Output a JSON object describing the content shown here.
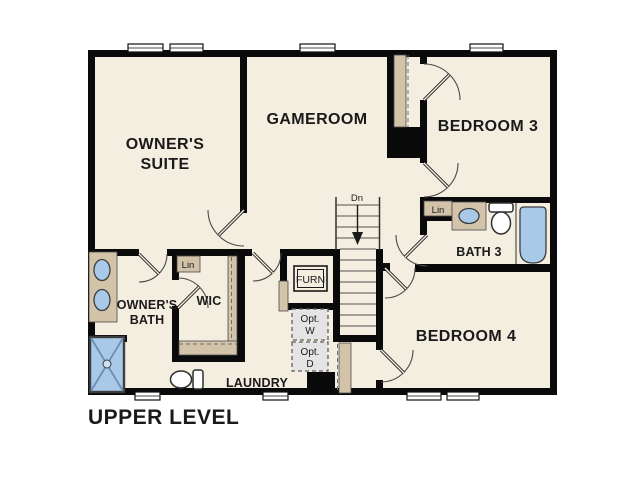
{
  "title": "UPPER LEVEL",
  "colors": {
    "background": "#ffffff",
    "floor": "#f4eee1",
    "wall": "#0a0a0a",
    "tan": "#d2c3a9",
    "fixture_blue": "#a9c9e9",
    "opt_gray": "#e4e4e4"
  },
  "rooms": {
    "owners_suite": {
      "line1": "OWNER'S",
      "line2": "SUITE"
    },
    "gameroom": {
      "label": "GAMEROOM"
    },
    "bedroom3": {
      "label": "BEDROOM 3"
    },
    "bath3": {
      "label": "BATH 3"
    },
    "bedroom4": {
      "label": "BEDROOM 4"
    },
    "owners_bath": {
      "line1": "OWNER'S",
      "line2": "BATH"
    },
    "wic": {
      "label": "WIC"
    },
    "laundry": {
      "label": "LAUNDRY"
    }
  },
  "annotations": {
    "stairs_down": "Dn",
    "linen_wic": "Lin",
    "linen_bath3": "Lin",
    "furnace": "FURN",
    "opt_washer_line1": "Opt.",
    "opt_washer_line2": "W",
    "opt_dryer_line1": "Opt.",
    "opt_dryer_line2": "D"
  }
}
